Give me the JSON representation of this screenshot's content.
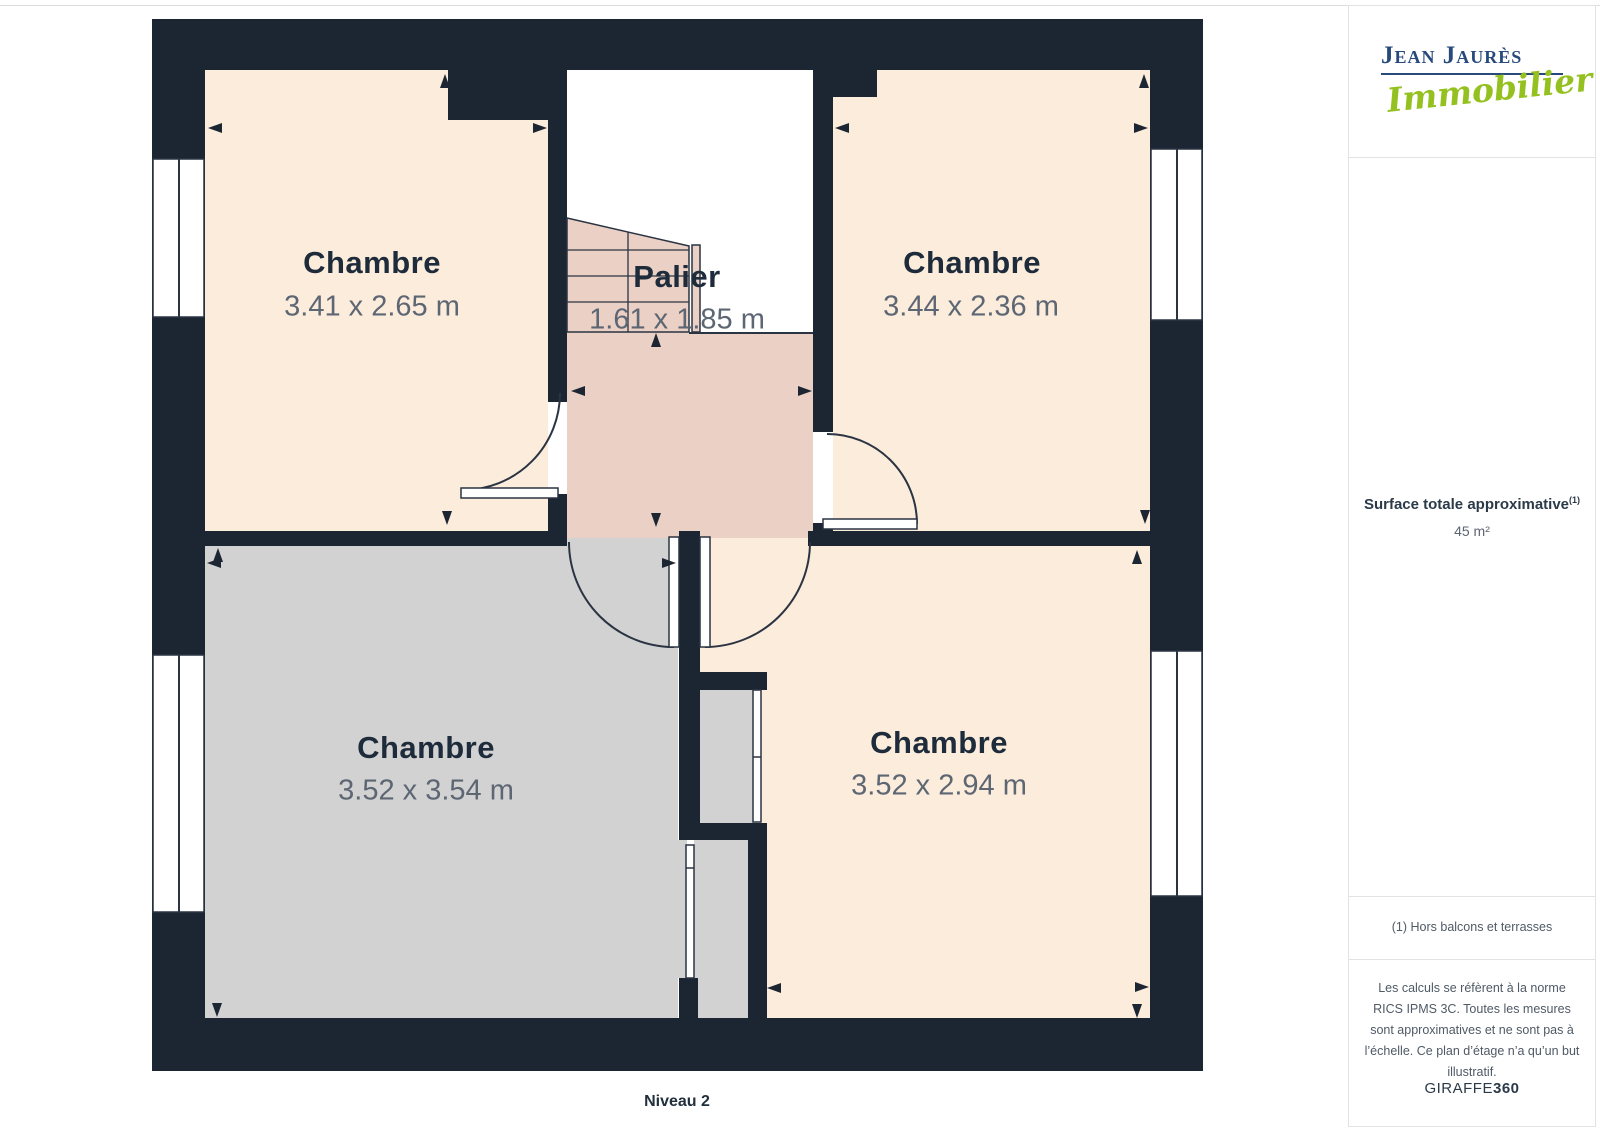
{
  "page": {
    "floor_label": "Niveau 2"
  },
  "rooms": [
    {
      "id": "chambre-top-left",
      "name": "Chambre",
      "dims": "3.41 x 2.65 m"
    },
    {
      "id": "chambre-top-right",
      "name": "Chambre",
      "dims": "3.44 x 2.36 m"
    },
    {
      "id": "palier",
      "name": "Palier",
      "dims": "1.61 x 1.85 m"
    },
    {
      "id": "chambre-bottom-left",
      "name": "Chambre",
      "dims": "3.52 x 3.54 m"
    },
    {
      "id": "chambre-bottom-right",
      "name": "Chambre",
      "dims": "3.52 x 2.94 m"
    }
  ],
  "sidebar": {
    "logo": {
      "name": "Jean Jaurès",
      "tagline": "Immobilier"
    },
    "surface": {
      "title": "Surface totale approximative",
      "sup": "(1)",
      "value": "45 m²"
    },
    "footnote": "(1) Hors balcons et terrasses",
    "disclaimer": "Les calculs se réfèrent à la norme RICS IPMS 3C. Toutes les mesures sont approximatives et ne sont pas à l’échelle. Ce plan d’étage n’a qu’un but illustratif.",
    "brand": {
      "name": "GIRAFFE",
      "suffix": "360"
    }
  },
  "colors": {
    "wall": "#1c2633",
    "room_cream": "#fcecdc",
    "landing_pink": "#ebd0c5",
    "room_gray": "#d2d2d2",
    "logo_navy": "#27497b",
    "logo_green": "#94c11f",
    "label_ink": "#1d2b3a",
    "dimension_text": "#5d6673"
  }
}
